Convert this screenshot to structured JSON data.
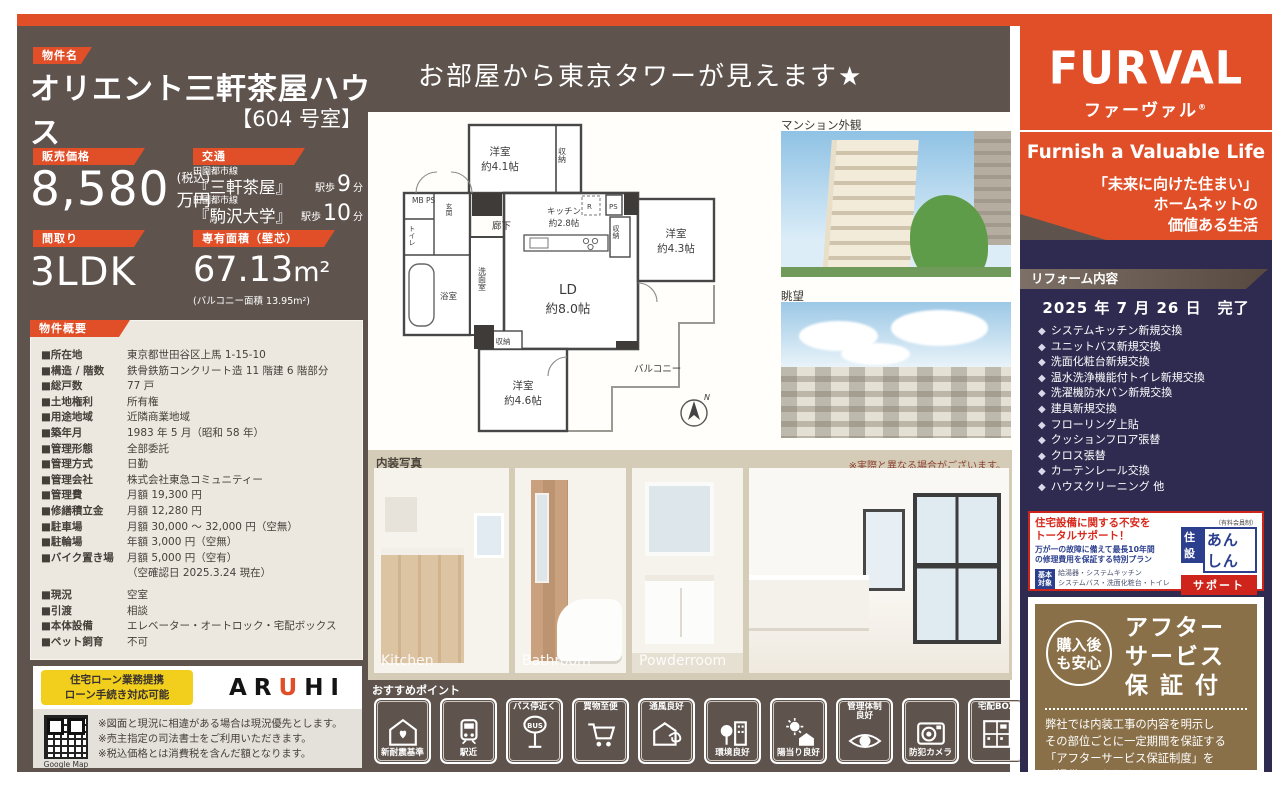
{
  "property": {
    "tag": "物件名",
    "name": "オリエント三軒茶屋ハウス",
    "room": "【604 号室】"
  },
  "headline": "お部屋から東京タワーが見えます★",
  "price": {
    "tag": "販売価格",
    "value": "8,580",
    "tax": "(税込)",
    "unit": "万円"
  },
  "access": {
    "tag": "交通",
    "routes": [
      {
        "line": "田園都市線",
        "station": "『三軒茶屋』",
        "walk": "駅歩",
        "minutes": "9",
        "min_unit": "分"
      },
      {
        "line": "田園都市線",
        "station": "『駒沢大学』",
        "walk": "駅歩",
        "minutes": "10",
        "min_unit": "分"
      }
    ]
  },
  "madori": {
    "tag": "間取り",
    "value": "3LDK"
  },
  "area": {
    "tag": "専有面積（壁芯）",
    "value": "67.13",
    "unit": "m²",
    "note": "(バルコニー面積 13.95m²)"
  },
  "overview": {
    "tag": "物件概要",
    "rows": [
      {
        "label": "■所在地",
        "value": "東京都世田谷区上馬 1-15-10"
      },
      {
        "label": "■構造 / 階数",
        "value": "鉄骨鉄筋コンクリート造 11 階建 6 階部分"
      },
      {
        "label": "■総戸数",
        "value": "77 戸"
      },
      {
        "label": "■土地権利",
        "value": "所有権"
      },
      {
        "label": "■用途地域",
        "value": "近隣商業地域"
      },
      {
        "label": "■築年月",
        "value": "1983 年 5 月（昭和 58 年）"
      },
      {
        "label": "■管理形態",
        "value": "全部委託"
      },
      {
        "label": "■管理方式",
        "value": "日勤"
      },
      {
        "label": "■管理会社",
        "value": "株式会社東急コミュニティー"
      },
      {
        "label": "■管理費",
        "value": "月額 19,300 円"
      },
      {
        "label": "■修繕積立金",
        "value": "月額 12,280 円"
      },
      {
        "label": "■駐車場",
        "value": "月額 30,000 ～ 32,000 円（空無）"
      },
      {
        "label": "■駐輪場",
        "value": "年額 3,000 円（空無）"
      },
      {
        "label": "■バイク置き場",
        "value": "月額 5,000 円（空有）"
      },
      {
        "label": "",
        "value": "（空確認日 2025.3.24 現在）"
      },
      {
        "label": "■現況",
        "value": "空室"
      },
      {
        "label": "■引渡",
        "value": "相談"
      },
      {
        "label": "■本体設備",
        "value": "エレベーター・オートロック・宅配ボックス"
      },
      {
        "label": "■ペット飼育",
        "value": "不可"
      }
    ]
  },
  "loan": {
    "badge_line1": "住宅ローン業務提携",
    "badge_line2": "ローン手続き対応可能",
    "brand_a": "AR",
    "brand_u": "U",
    "brand_hi": "HI",
    "qr_caption": "Google Map",
    "notes": [
      "※図面と現況に相違がある場合は現況優先とします。",
      "※売主指定の司法書士をご利用いただきます。",
      "※税込価格とは消費税を含んだ額となります。"
    ]
  },
  "floorplan": {
    "bed1": "洋室",
    "bed1_size": "約4.1帖",
    "bed2": "洋室",
    "bed2_size": "約4.3帖",
    "bed3": "洋室",
    "bed3_size": "約4.6帖",
    "ld": "LD",
    "ld_size": "約8.0帖",
    "kitchen": "キッチン",
    "kitchen_size": "約2.8帖",
    "closet1": "収納",
    "closet2": "収納",
    "closet3": "収納",
    "mbps": "MB PS",
    "ps": "PS",
    "r": "R",
    "toilet": "トイレ",
    "bath": "浴室",
    "wash": "洗面室",
    "hall": "廊下",
    "genkan": "玄関",
    "balcony": "バルコニー",
    "north": "N"
  },
  "photos": {
    "exterior_label": "マンション外観",
    "view_label": "眺望",
    "interior_title": "内装写真",
    "interior_note": "※実際と異なる場合がございます。",
    "captions": [
      "Kitchen",
      "Bathroom",
      "Powderroom"
    ]
  },
  "points": {
    "title": "おすすめポイント",
    "items": [
      {
        "label": "新耐震基準"
      },
      {
        "label": "駅近"
      },
      {
        "label": "バス停近く"
      },
      {
        "label": "買物至便"
      },
      {
        "label": "通風良好"
      },
      {
        "label": "環境良好"
      },
      {
        "label": "陽当り良好"
      },
      {
        "label": "管理体制",
        "label2": "良好"
      },
      {
        "label": "防犯カメラ"
      },
      {
        "label": "宅配BOX"
      }
    ],
    "bus": "BUS"
  },
  "brand": {
    "logo": "FURVAL",
    "kana": "ファーヴァル",
    "reg": "®",
    "slogan": "Furnish a Valuable Life",
    "msg1": "「未来に向けた住まい」",
    "msg2": "ホームネットの",
    "msg3": "価値ある生活"
  },
  "reform": {
    "tag": "リフォーム内容",
    "date": "2025 年 7 月 26 日　完了",
    "bullet": "◆",
    "items": [
      "システムキッチン新規交換",
      "ユニットバス新規交換",
      "洗面化粧台新規交換",
      "温水洗浄機能付トイレ新規交換",
      "洗濯機防水パン新規交換",
      "建具新規交換",
      "フローリング上貼",
      "クッションフロア張替",
      "クロス張替",
      "カーテンレール交換",
      "ハウスクリーニング 他"
    ]
  },
  "anshin": {
    "red1": "住宅設備に関する不安を",
    "red2": "トータルサポート！",
    "blue1": "万が一の故障に備えて最長10年間",
    "blue2": "の修理費用を保証する特別プラン",
    "chip1": "基本",
    "chip2": "対象",
    "targets1": "給湯器・システムキッチン",
    "targets2": "システムバス・洗面化粧台・トイレ",
    "note": "（有料会員制）",
    "logo_a": "住設",
    "logo_b": "あんしん",
    "logo_c": "サポート"
  },
  "after": {
    "badge1": "購入後",
    "badge2": "も安心",
    "title1": "アフター",
    "title2": "サービス",
    "title3": "保 証 付",
    "body1": "弊社では内装工事の内容を明示し",
    "body2": "その部位ごとに一定期間を保証する",
    "body3": "「アフターサービス保証制度」を",
    "body4": "ご提供しております。"
  }
}
